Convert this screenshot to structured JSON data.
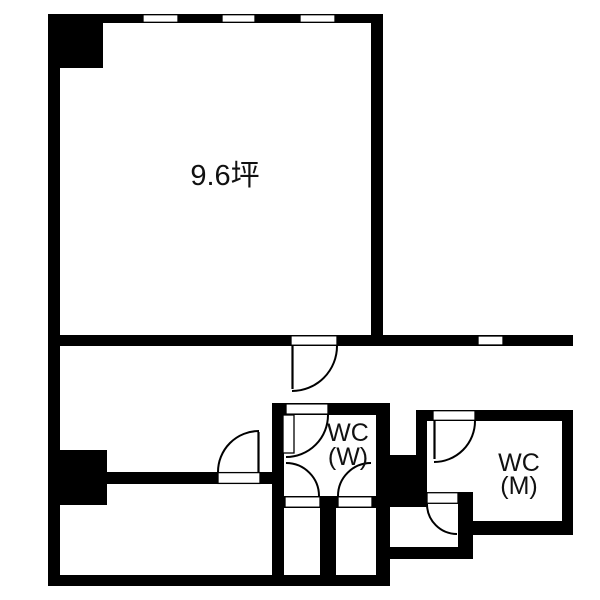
{
  "floorplan": {
    "background_color": "#ffffff",
    "wall_color": "#000000",
    "text_color": "#111111",
    "rooms": {
      "main_room": {
        "area_label": "9.6坪"
      },
      "toilet_women": {
        "label_line1": "WC",
        "label_line2": "(W)"
      },
      "toilet_men": {
        "label_line1": "WC",
        "label_line2": "(M)"
      }
    }
  }
}
